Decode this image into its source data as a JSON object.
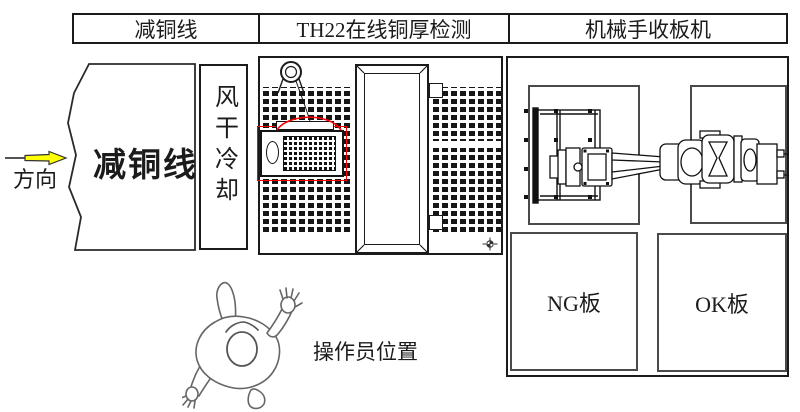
{
  "header": {
    "cells": [
      {
        "label": "减铜线"
      },
      {
        "label": "TH22在线铜厚检测"
      },
      {
        "label": "机械手收板机"
      }
    ]
  },
  "flow": {
    "direction_label": "方向"
  },
  "stations": {
    "copper_reduction": {
      "label": "减铜线"
    },
    "air_dry_cooling": {
      "label": "风干冷却"
    },
    "ng_bin": {
      "label": "NG板"
    },
    "ok_bin": {
      "label": "OK板"
    },
    "operator": {
      "label": "操作员位置"
    }
  },
  "colors": {
    "line": "#1b1b1b",
    "highlight_red": "#ff0000",
    "arrow_yellow": "#ffff00",
    "box_gray": "#4a4a4a"
  }
}
